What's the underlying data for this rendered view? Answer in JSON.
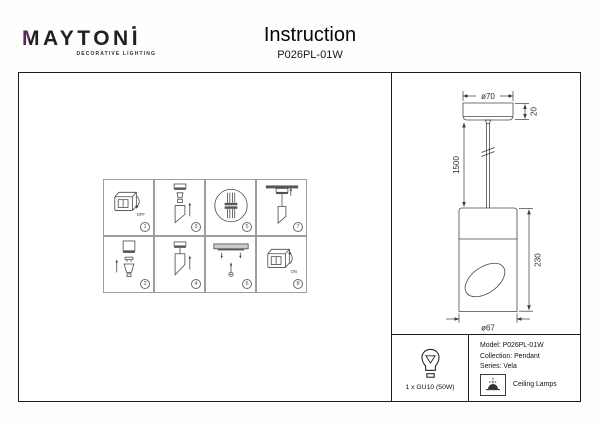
{
  "brand": {
    "m": "M",
    "mid": "AYTON",
    "i": "I",
    "tagline": "DECORATIVE LIGHTING",
    "purple": "#572a5a"
  },
  "header": {
    "title": "Instruction",
    "model": "P026PL-01W"
  },
  "steps": {
    "items": [
      {
        "num": "1",
        "label": "turn-switch-off",
        "caption": "OFF"
      },
      {
        "num": "3",
        "label": "attach-suspension-parts"
      },
      {
        "num": "5",
        "label": "connect-wires"
      },
      {
        "num": "7",
        "label": "mount-canopy-to-ceiling"
      },
      {
        "num": "2",
        "label": "insert-gu10-bulb"
      },
      {
        "num": "4",
        "label": "assemble-body"
      },
      {
        "num": "6",
        "label": "install-ceiling-anchors"
      },
      {
        "num": "8",
        "label": "turn-switch-on",
        "caption": "ON"
      }
    ]
  },
  "drawing": {
    "canopy_diameter": "ø70",
    "canopy_height": "20",
    "cord_length": "1500",
    "body_height": "230",
    "body_diameter": "ø67"
  },
  "spec": {
    "lamp": "1 x GU10 (50W)",
    "model": "Model: P026PL-01W",
    "collection": "Collection: Pendant",
    "series": "Series: Vela",
    "category": "Ceiling Lamps"
  }
}
